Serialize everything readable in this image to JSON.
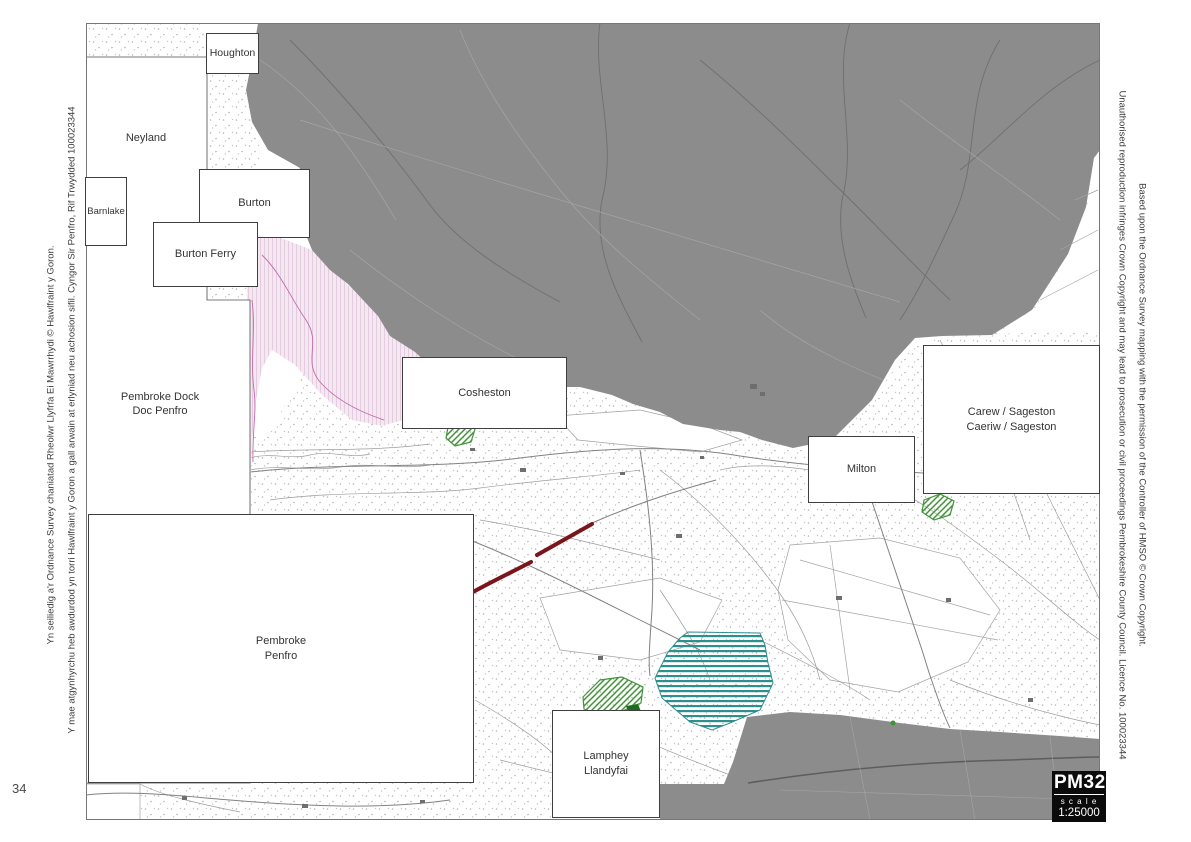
{
  "page": {
    "number": "34"
  },
  "badge": {
    "code": "PM32",
    "scale_word": "s c a l e",
    "scale_ratio": "1:25000"
  },
  "margins": {
    "left_outer": "Yn seiliedig a'r Ordnance Survey chaniatad Rheolwr Llyfrfa Ei Mawrrhydi © Hawlfraint y Goron.",
    "left_inner": "Y mae atgynhyrchu heb awdurdod yn torri Hawlfraint y Goron a gall arwain at erlyniad neu achosion sifil. Cyngor Sir Penfro, Rif Trwydded 100023344",
    "right_inner": "Unauthorised reproduction infringes Crown Copyright and may lead to prosecution or civil proceedings Pembrokeshire County Council. Licence No. 100023344",
    "right_outer": "Based upon the Ordnance Survey mapping with the permission of the Controller of HMSO © Crown Copyright."
  },
  "map": {
    "labels": {
      "houghton": "Houghton",
      "neyland": "Neyland",
      "barnlake": "Barnlake",
      "burton": "Burton",
      "burton_ferry": "Burton Ferry",
      "pembroke_dock_1": "Pembroke Dock",
      "pembroke_dock_2": "Doc Penfro",
      "cosheston": "Cosheston",
      "milton": "Milton",
      "carew_1": "Carew / Sageston",
      "carew_2": "Caeriw / Sageston",
      "pembroke_1": "Pembroke",
      "pembroke_2": "Penfro",
      "lamphey_1": "Lamphey",
      "lamphey_2": "Llandyfai"
    },
    "colors": {
      "settlement_gray": "#8c8c8c",
      "pink_fill": "#f6e8f1",
      "pink_stripe": "#e4cce0",
      "pink_line": "#c36aab",
      "teal": "#2e8f8f",
      "green": "#3f9437",
      "green_dark": "#1d6b1d",
      "road_red": "#7a151c",
      "map_line": "#9c9c9c"
    }
  }
}
